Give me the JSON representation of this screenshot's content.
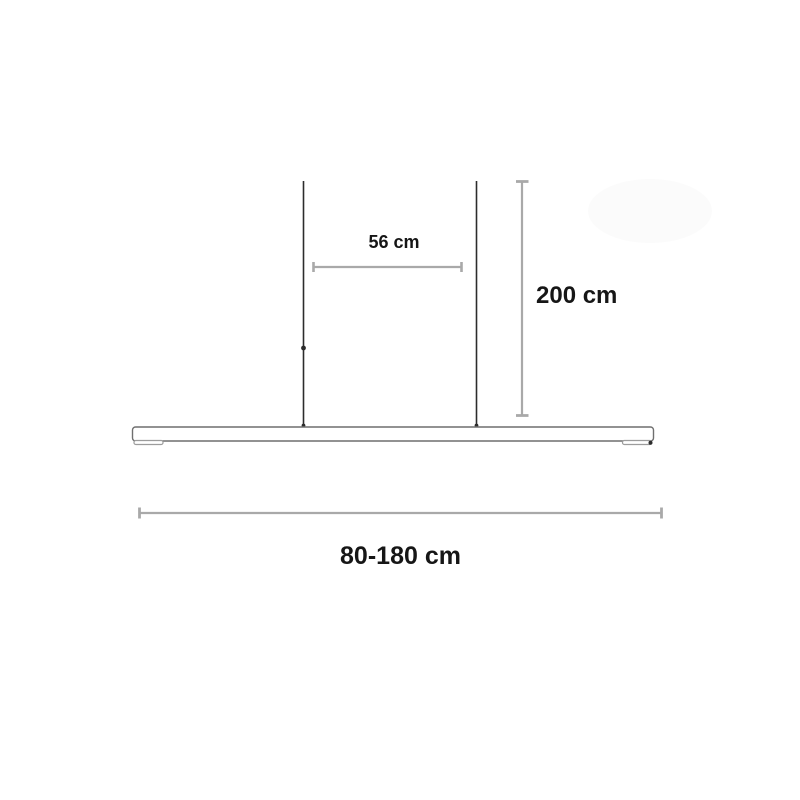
{
  "page": {
    "background": "#ffffff"
  },
  "diagram": {
    "labels": {
      "cable_spacing": "56 cm",
      "suspension_height": "200 cm",
      "lamp_length": "80-180 cm"
    },
    "colors": {
      "cable": "#2c2c2c",
      "bar_outline": "#6f6f6f",
      "endcap_outline": "#9c9c9c",
      "dimension_line": "#a9a9a9",
      "text": "#161616",
      "background": "#ffffff",
      "watermark_blob": "#fbfbfb"
    }
  }
}
